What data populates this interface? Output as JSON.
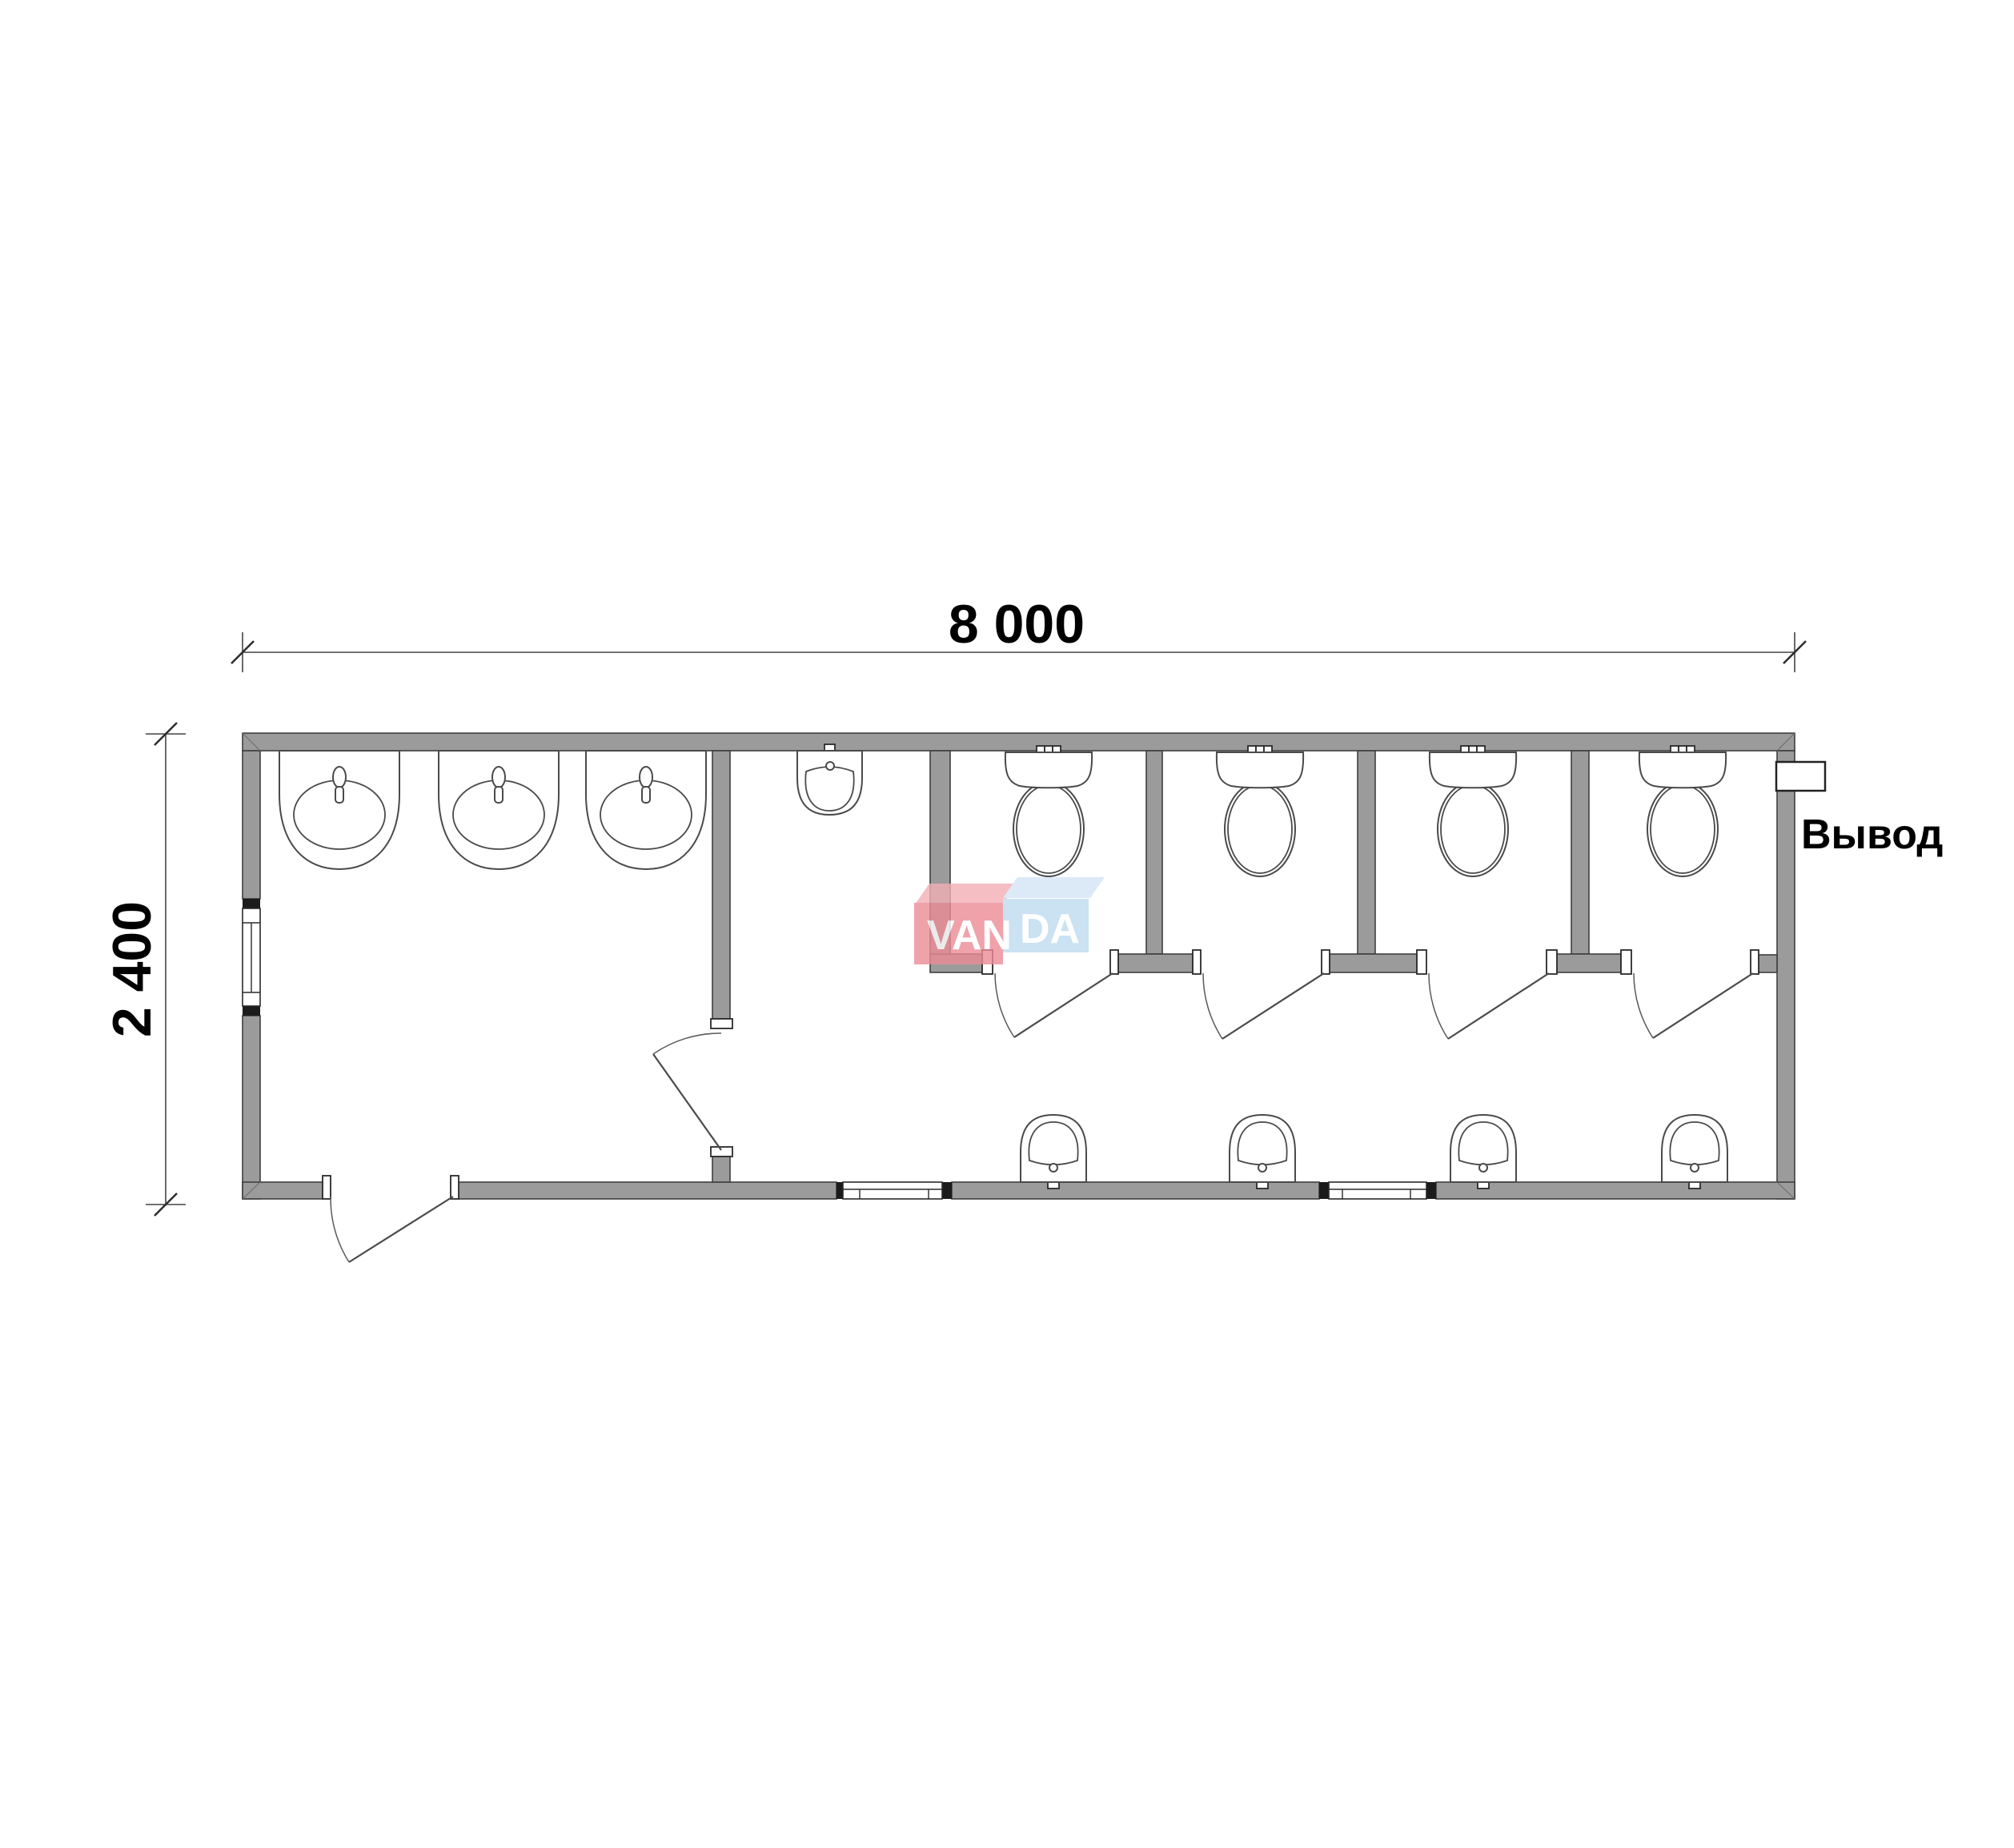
{
  "page": {
    "background": "#ffffff"
  },
  "dimension_annotations": {
    "overall_width": "8 000",
    "overall_height": "2 400"
  },
  "labels": {
    "utility_outlet": "Вывод"
  },
  "watermark_logo": {
    "word": "VANDA",
    "left_segment": "VAN",
    "right_segment": "DA",
    "red_box": "#ec8c96",
    "red_box_top": "#f2afb5",
    "blue_box": "#bedbee",
    "blue_box_top": "#d3e6f4",
    "letter_color": "#ffffff"
  },
  "drawing_colors": {
    "wall_fill": "#9b9b9b",
    "wall_outline": "#3f3f3f",
    "fixture_line": "#4a4a4a",
    "dimension_line": "#444444",
    "text_color": "#000000"
  },
  "fixture_inventory": {
    "washbasins": 3,
    "urinals": 1,
    "toilets": 4,
    "hand_wash_fountains": 4,
    "toilet_stalls": 4,
    "windows": 3,
    "entrance_doors": 1,
    "interior_doors": 5
  }
}
